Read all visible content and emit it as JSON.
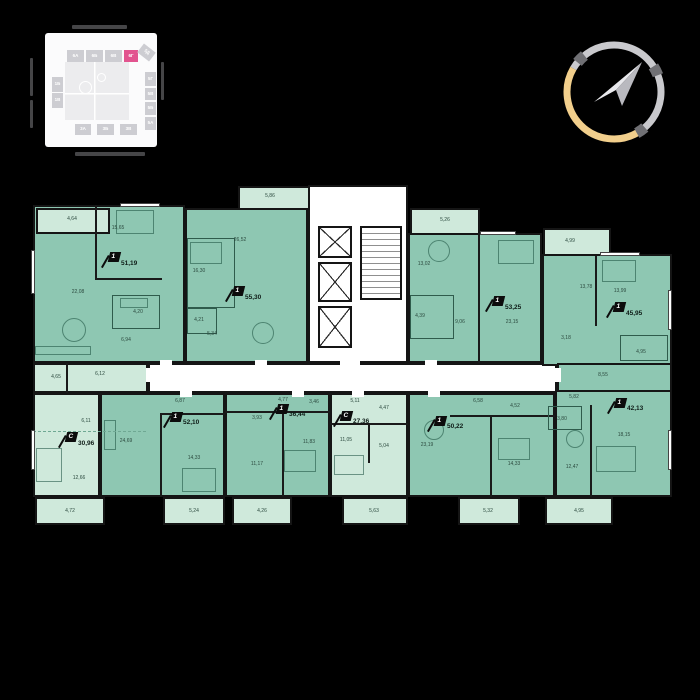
{
  "site_map": {
    "highlighted": "6Г",
    "highlight_color": "#e2548f",
    "top_row": [
      "6А",
      "6Б",
      "6В",
      "6Г",
      "5Д"
    ],
    "right_col": [
      "5Г",
      "5В",
      "5Б",
      "5А"
    ],
    "bottom_row": [
      "3А",
      "3Б",
      "3В"
    ],
    "left_col": [
      "1Б",
      "1В"
    ]
  },
  "compass": {
    "gold": "#f2cf8c",
    "silver": "#c9c9cd",
    "notch": "#707074"
  },
  "plan": {
    "colors": {
      "one_room_fill": "#8ec7b2",
      "studio_fill": "#cfe9db",
      "wall": "#151515",
      "core": "#ffffff"
    },
    "apartments": [
      {
        "type": "1",
        "area": "51,19",
        "rooms": [
          "4,64",
          "15,65",
          "22,08",
          "4,20",
          "6,94"
        ]
      },
      {
        "type": "1",
        "area": "55,30",
        "rooms": [
          "5,86",
          "26,52",
          "16,30",
          "4,21",
          "5,34"
        ]
      },
      {
        "type": "1",
        "area": "53,25",
        "rooms": [
          "5,26",
          "13,02",
          "4,39",
          "9,06",
          "23,15"
        ]
      },
      {
        "type": "1",
        "area": "45,95",
        "rooms": [
          "4,99",
          "13,78",
          "13,99",
          "3,18",
          "8,55",
          "4,95"
        ]
      },
      {
        "type": "С",
        "area": "30,96",
        "rooms": [
          "4,65",
          "6,12",
          "6,11",
          "12,66",
          "4,72"
        ]
      },
      {
        "type": "1",
        "area": "52,10",
        "rooms": [
          "6,87",
          "24,69",
          "14,33",
          "5,24"
        ]
      },
      {
        "type": "1",
        "area": "36,44",
        "rooms": [
          "4,77",
          "3,46",
          "3,93",
          "11,83",
          "11,17",
          "4,26"
        ]
      },
      {
        "type": "С",
        "area": "27,36",
        "rooms": [
          "5,11",
          "4,47",
          "11,05",
          "5,04",
          "5,63"
        ]
      },
      {
        "type": "1",
        "area": "50,22",
        "rooms": [
          "6,58",
          "4,52",
          "23,19",
          "14,33",
          "5,32"
        ]
      },
      {
        "type": "1",
        "area": "42,13",
        "rooms": [
          "5,82",
          "3,80",
          "12,47",
          "18,15",
          "4,95"
        ]
      }
    ]
  }
}
